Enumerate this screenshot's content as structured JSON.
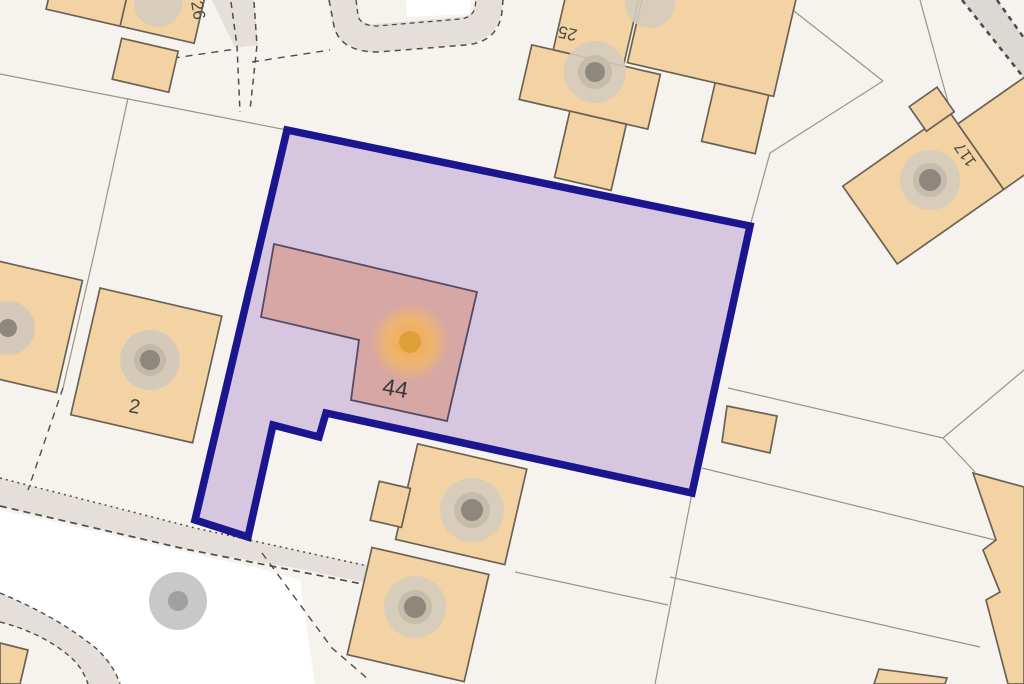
{
  "map": {
    "description": "Property boundary plan highlighting plot of house 44",
    "labels": {
      "house44": "44",
      "house2": "2",
      "house25": "25",
      "house26": "26",
      "house117": "117"
    },
    "colors": {
      "background": "#f6f3ee",
      "boundary_stroke": "#1b1690",
      "boundary_fill": "#d4c1dd",
      "highlight_house_fill": "#d7a7a5",
      "highlight_house_stroke": "#564b63",
      "building_fill": "#f3d3a3",
      "building_stroke": "#6b6254",
      "marker_halo": "#f5b95e",
      "marker_dot": "#dfa03a",
      "road_fill": "#e4dfda",
      "parcel_line": "#9a938a",
      "dash_line": "#4d4d4d",
      "tree_fill": "#d5cbbc",
      "tree_dot": "#8d877c",
      "white_area": "#ffffff"
    }
  }
}
